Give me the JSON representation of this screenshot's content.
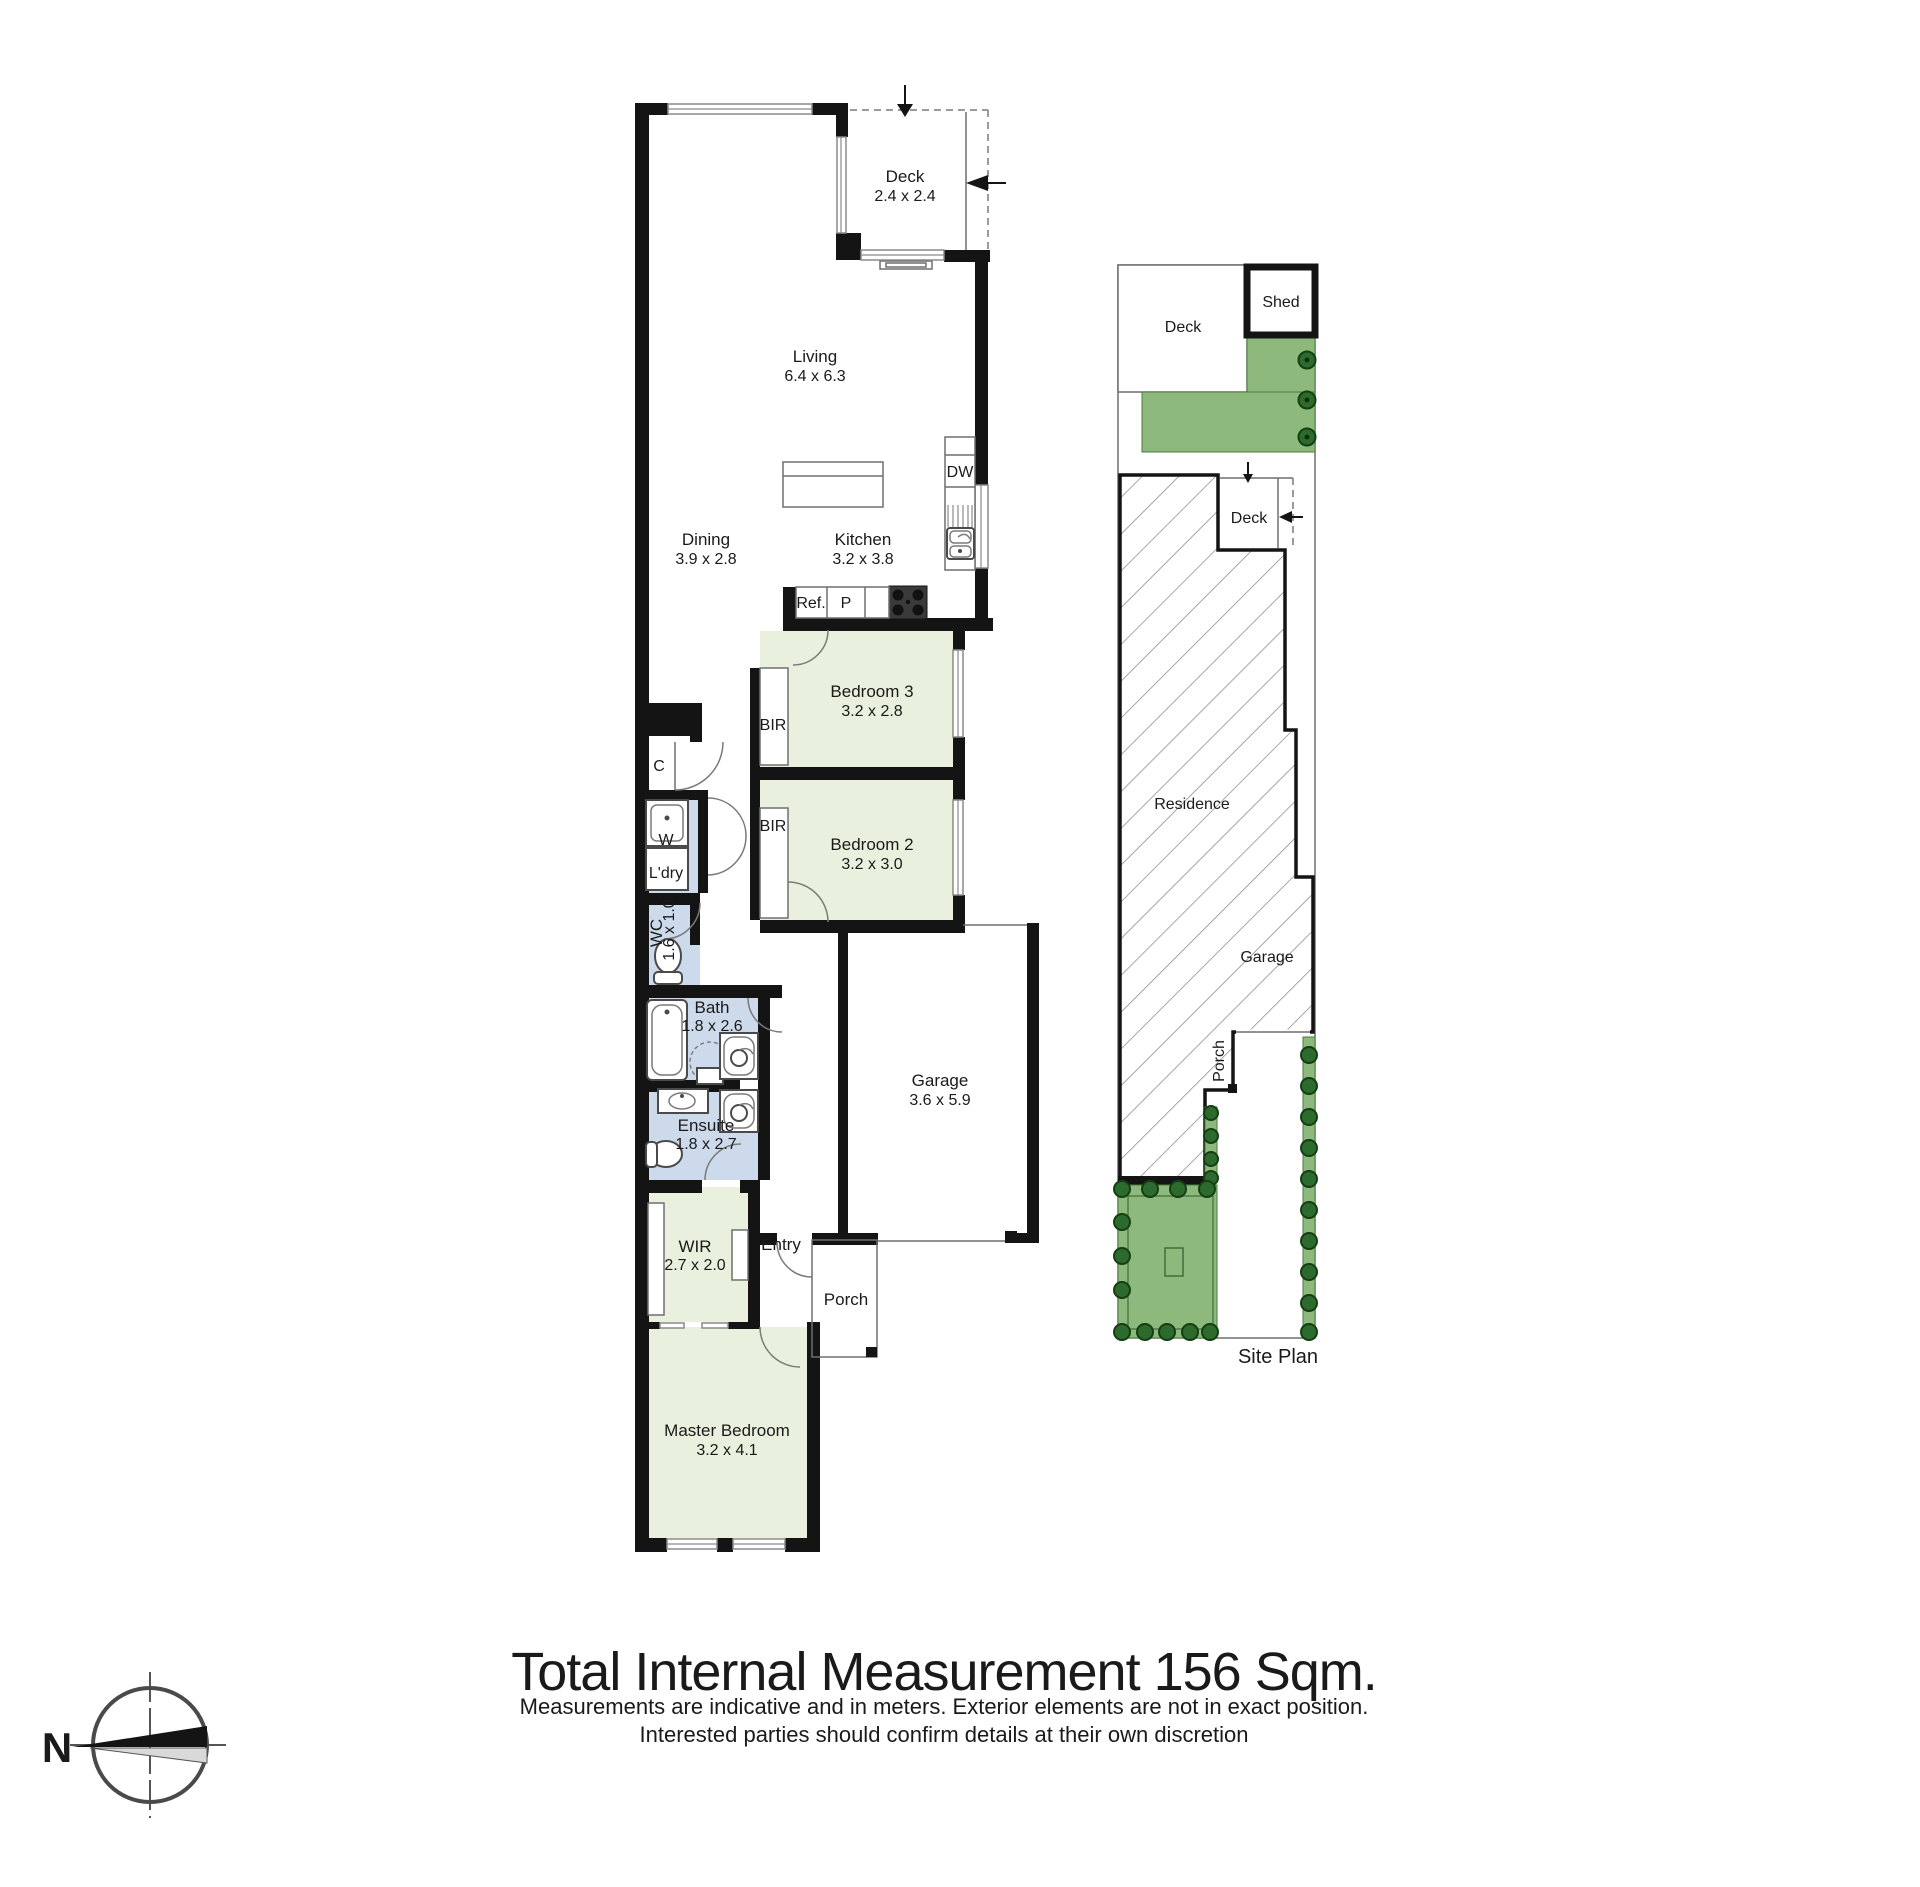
{
  "floorplan": {
    "rooms": {
      "living": {
        "name": "Living",
        "dims": "6.4 x 6.3"
      },
      "dining": {
        "name": "Dining",
        "dims": "3.9 x 2.8"
      },
      "kitchen": {
        "name": "Kitchen",
        "dims": "3.2 x 3.8"
      },
      "deck": {
        "name": "Deck",
        "dims": "2.4 x 2.4"
      },
      "bedroom3": {
        "name": "Bedroom 3",
        "dims": "3.2 x 2.8"
      },
      "bedroom2": {
        "name": "Bedroom 2",
        "dims": "3.2 x 3.0"
      },
      "master_bedroom": {
        "name": "Master Bedroom",
        "dims": "3.2 x 4.1"
      },
      "wir": {
        "name": "WIR",
        "dims": "2.7 x 2.0"
      },
      "bath": {
        "name": "Bath",
        "dims": "1.8 x 2.6"
      },
      "ensuite": {
        "name": "Ensuite",
        "dims": "1.8 x 2.7"
      },
      "wc": {
        "name": "WC",
        "dims": "1.6 x 1.0"
      },
      "garage": {
        "name": "Garage",
        "dims": "3.6 x 5.9"
      },
      "laundry": {
        "name": "L'dry"
      },
      "entry": {
        "name": "Entry"
      },
      "porch": {
        "name": "Porch"
      }
    },
    "fixtures": {
      "bir": "BIR",
      "linen": "C",
      "washer": "W",
      "fridge": "Ref.",
      "pantry": "P",
      "dishwasher": "DW"
    }
  },
  "siteplan": {
    "deck_top": "Deck",
    "shed": "Shed",
    "deck_mid": "Deck",
    "residence": "Residence",
    "garage": "Garage",
    "porch": "Porch",
    "caption": "Site Plan"
  },
  "footer": {
    "title": "Total Internal Measurement 156 Sqm.",
    "line1": "Measurements are indicative and in meters. Exterior elements are not in exact position.",
    "line2": "Interested parties should confirm details at their own discretion"
  },
  "compass": {
    "north_label": "N"
  },
  "colors": {
    "room_green": "#e9f0dd",
    "room_blue": "#cddaeb",
    "site_green": "#8dba7c",
    "tree_green": "#2d6a2d",
    "wall_black": "#141414"
  }
}
